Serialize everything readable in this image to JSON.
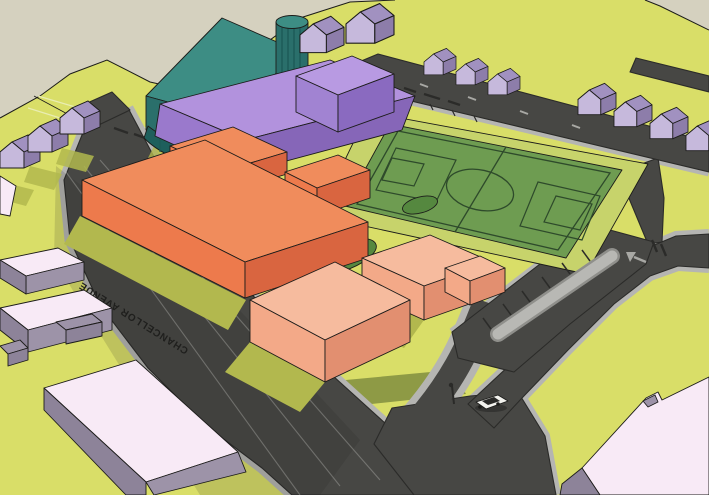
{
  "scene": {
    "street_label": "CHANCELLOR AVENUE"
  },
  "colors": {
    "background": "#d5d1bf",
    "grass": "#d9de68",
    "grass_dark": "#b2b84e",
    "grass_olive": "#8e9a45",
    "hill_line": "#e9edb2",
    "road": "#474744",
    "road_edge": "#2b2b29",
    "sidewalk": "#b5b5b2",
    "island": "#b8b8b4",
    "island_edge": "#8f8f8b",
    "marking": "#a8a8a4",
    "field": "#6e9c51",
    "field_border": "#c7d36b",
    "field_line": "#2e4a2b",
    "bush": "#55883f",
    "orange_top": "#f08c5c",
    "orange_front": "#ed7a4c",
    "orange_side": "#d96540",
    "pale_top": "#f6bb9e",
    "pale_front": "#f3a988",
    "pale_side": "#e28f70",
    "purple_top": "#b292dd",
    "purple_front": "#9a79cc",
    "purple_side": "#8666b8",
    "ptall_top": "#b89ae2",
    "ptall_front": "#a183d2",
    "ptall_side": "#8a6ac0",
    "teal_roof": "#3d8d84",
    "teal_face": "#2a6f6b",
    "teal_dark": "#1e5f5c",
    "teal_stripe": "#1d5a57",
    "hroof_l": "#cfc3e4",
    "hroof_r": "#a191c0",
    "hfront": "#c6b9dc",
    "hside": "#8d7daa",
    "pink_top": "#f8eaf6",
    "pink_side": "#9d93a8",
    "pink_dark": "#8d8399",
    "car_body": "#f2f2ee",
    "car_glass": "#2a2a28",
    "shadow": "#1c1c1c",
    "text": "#1f1f1d",
    "edge": "#1c1c1a"
  }
}
